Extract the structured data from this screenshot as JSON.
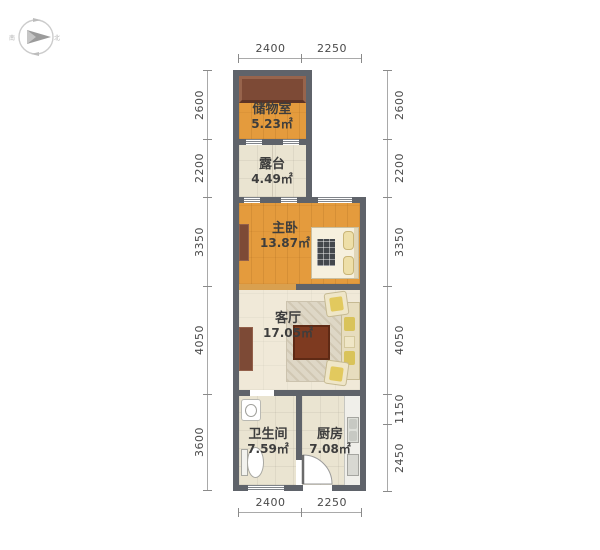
{
  "compass": {
    "south_label": "南",
    "north_label": "北"
  },
  "rooms": {
    "storage": {
      "name": "储物室",
      "area": "5.23㎡"
    },
    "terrace": {
      "name": "露台",
      "area": "4.49㎡"
    },
    "bedroom": {
      "name": "主卧",
      "area": "13.87㎡"
    },
    "living": {
      "name": "客厅",
      "area": "17.05㎡"
    },
    "bathroom": {
      "name": "卫生间",
      "area": "7.59㎡"
    },
    "kitchen": {
      "name": "厨房",
      "area": "7.08㎡"
    }
  },
  "dimensions": {
    "top": [
      "2400",
      "2250"
    ],
    "bottom": [
      "2400",
      "2250"
    ],
    "left": [
      "2600",
      "2200",
      "3350",
      "4050",
      "3600"
    ],
    "right": [
      "2600",
      "2200",
      "3350",
      "4050",
      "1150",
      "2450"
    ]
  },
  "colors": {
    "wall": "#5f636a",
    "wood_floor": "#e49b3d",
    "tile_floor": "#eae4d1",
    "living_floor": "#f0e9d8",
    "cabinet_brown": "#7d4a36",
    "coffee_table": "#7e3a20"
  }
}
